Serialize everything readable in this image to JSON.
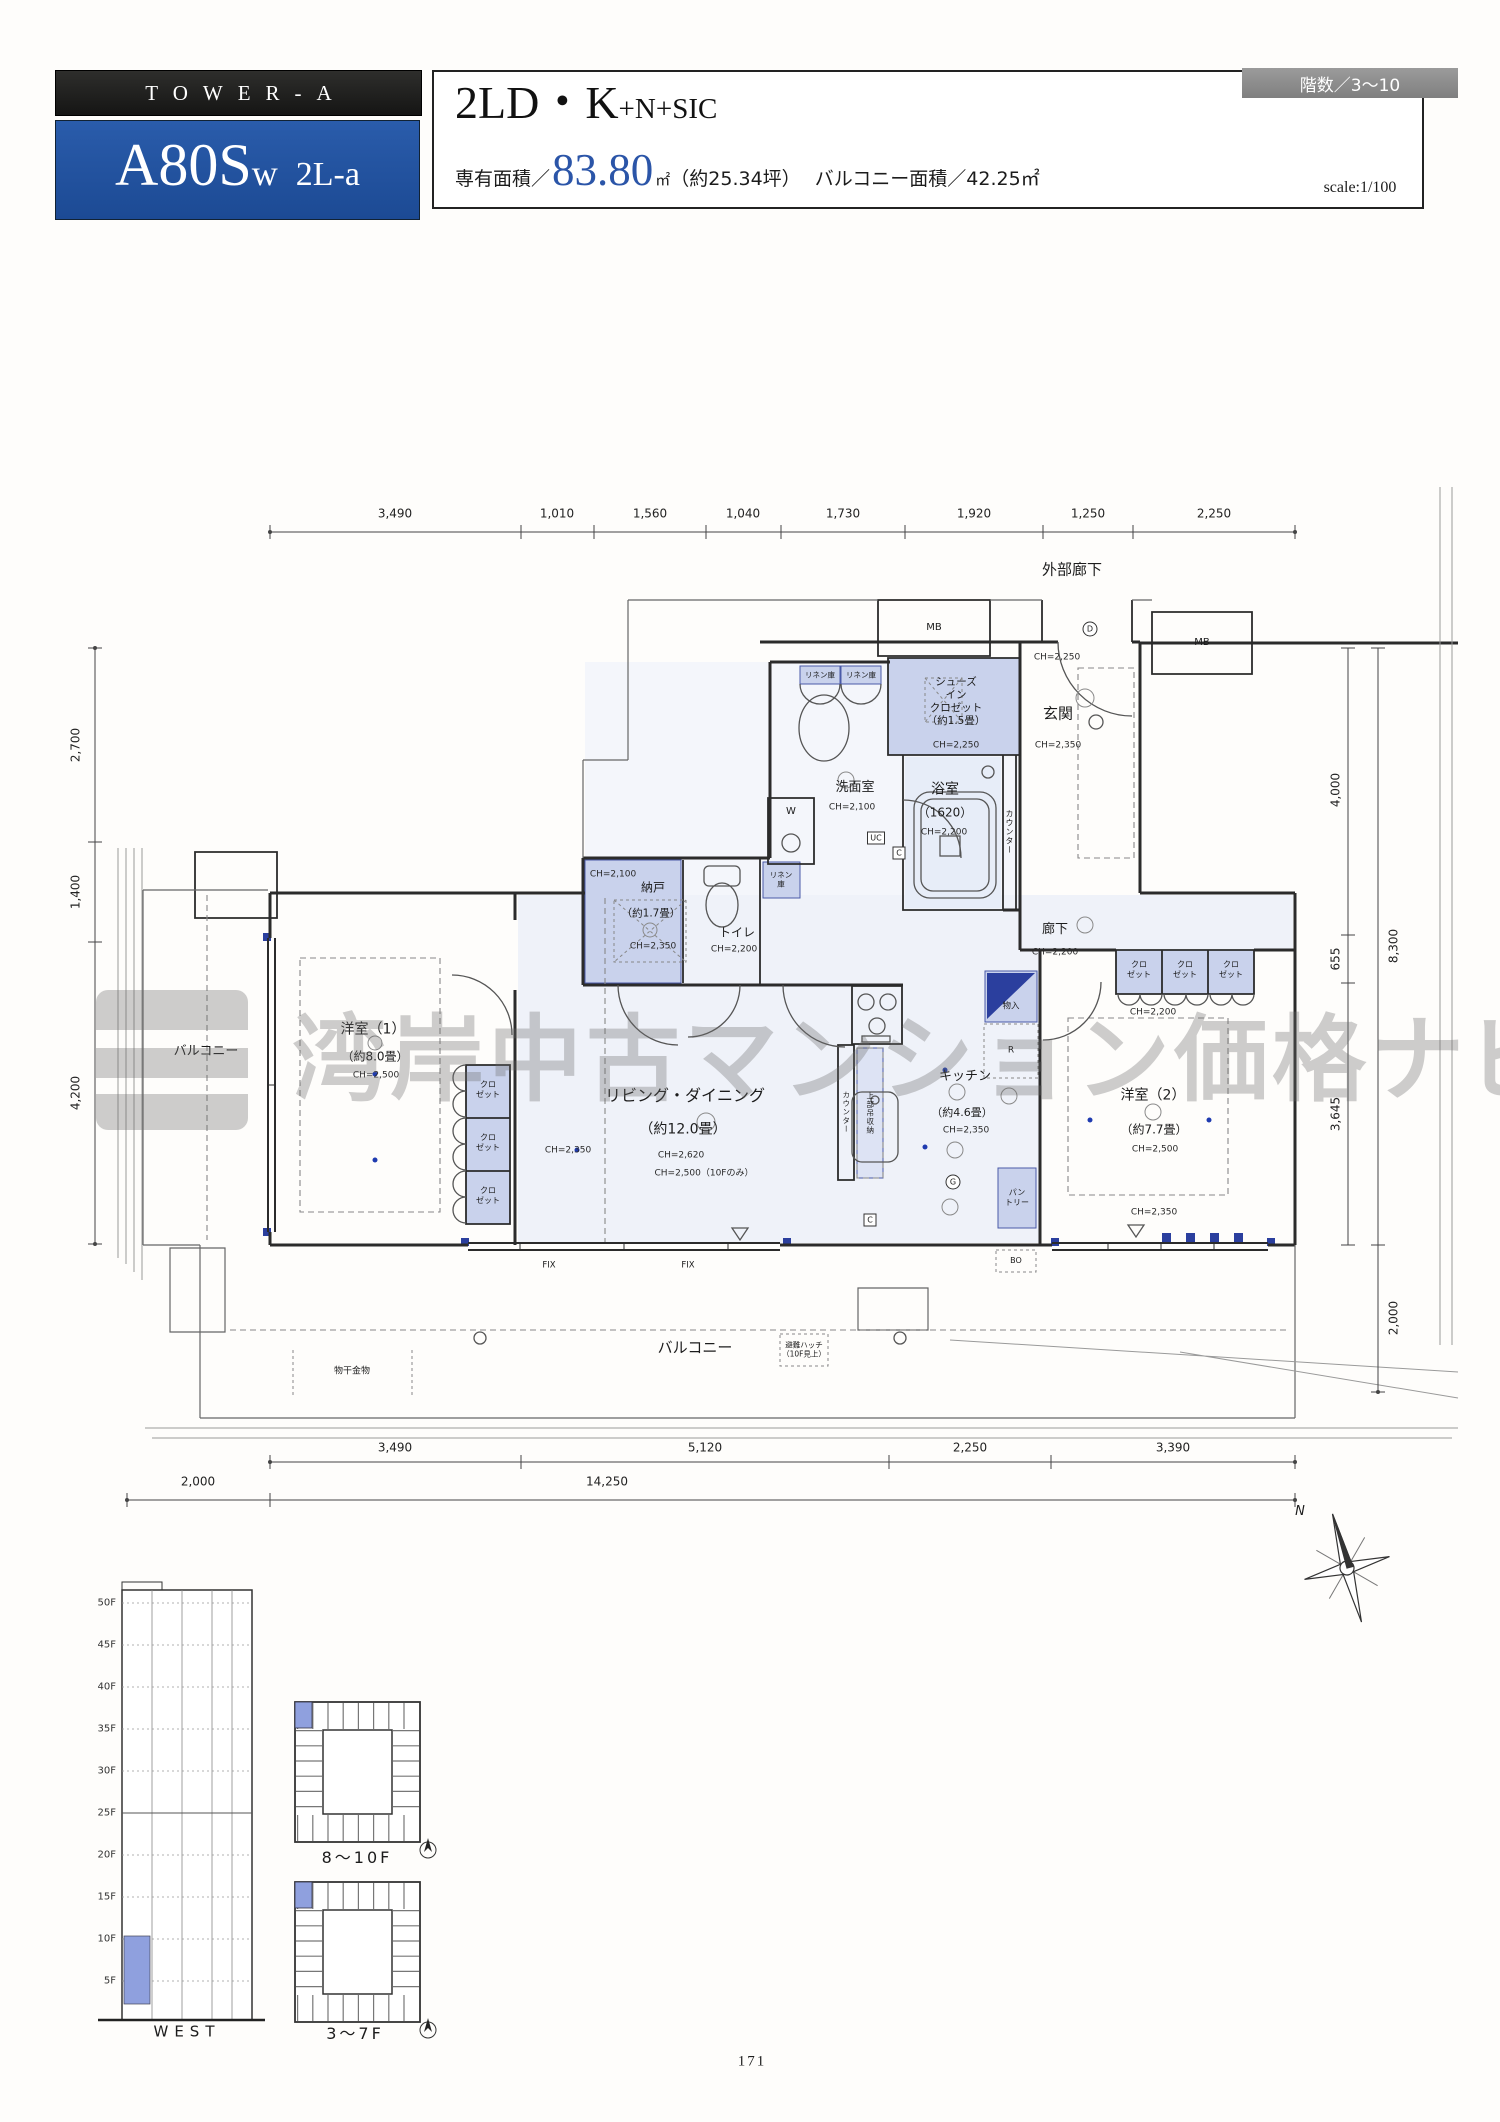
{
  "header": {
    "tower": "TOWER-A",
    "unit_main": "A80S",
    "unit_sub": "w",
    "unit_variant": "2L-a",
    "floors_badge": "階数／3～10",
    "plan_main": "2LD・K",
    "plan_suffix": "+N+SIC",
    "area_prefix": "専有面積／",
    "area_value": "83.80",
    "area_unit": "㎡",
    "area_tsubo": "（約25.34坪）",
    "balcony_area": "バルコニー面積／42.25㎡",
    "scale": "scale:1/100"
  },
  "dims": {
    "top": [
      "3,490",
      "1,010",
      "1,560",
      "1,040",
      "1,730",
      "1,920",
      "1,250",
      "2,250"
    ],
    "left": [
      "2,700",
      "1,400",
      "4,200"
    ],
    "right": [
      "4,000",
      "655",
      "3,645"
    ],
    "right_total": "8,300",
    "right_balcony": "2,000",
    "bottom": [
      "3,490",
      "5,120",
      "2,250",
      "3,390"
    ],
    "bottom_total": "14,250",
    "bottom_left": "2,000"
  },
  "plan": {
    "ext_corridor": "外部廊下",
    "mb": "MB",
    "linen": "リネン庫",
    "linen2": "リネン\n庫",
    "sic": "シューズ\nイン\nクロゼット\n（約1.5畳）",
    "sic_ch": "CH=2,250",
    "genkan": "玄関",
    "genkan_ch": "CH=2,350",
    "genkan_ch2": "CH=2,250",
    "wash": "洗面室",
    "wash_ch": "CH=2,100",
    "washer": "W",
    "bath": "浴室",
    "bath_size": "（1620）",
    "bath_ch": "CH=2,200",
    "uc": "UC",
    "c": "C",
    "d": "D",
    "g": "G",
    "r": "R",
    "bo": "BO",
    "counter": "カウンター",
    "nando": "納戸",
    "nando_size": "（約1.7畳）",
    "nando_ch1": "CH=2,100",
    "nando_ch2": "CH=2,350",
    "toilet": "トイレ",
    "toilet_ch": "CH=2,200",
    "hall": "廊下",
    "hall_ch": "CH=2,200",
    "closet": "クロ\nゼット",
    "closet_ch": "CH=2,200",
    "monoire": "物入",
    "kitchen": "キッチン",
    "kitchen_size": "（約4.6畳）",
    "kitchen_ch": "CH=2,350",
    "hanging": "上部吊収納",
    "pantry": "パン\nトリー",
    "ld": "リビング・ダイニング",
    "ld_size": "（約12.0畳）",
    "ld_ch1": "CH=2,350",
    "ld_ch2": "CH=2,620",
    "ld_ch3": "CH=2,500（10Fのみ）",
    "west1": "洋室（1）",
    "west1_size": "（約8.0畳）",
    "west1_ch": "CH=2,500",
    "west2": "洋室（2）",
    "west2_size": "（約7.7畳）",
    "west2_ch1": "CH=2,500",
    "west2_ch2": "CH=2,350",
    "balcony": "バルコニー",
    "fix": "FIX",
    "monohoshi": "物干金物",
    "hatch": "避難ハッチ\n（10F見上）",
    "compass_n": "N"
  },
  "elevation": {
    "floors": [
      "50F",
      "45F",
      "40F",
      "35F",
      "30F",
      "25F",
      "20F",
      "15F",
      "10F",
      "5F"
    ],
    "west": "WEST"
  },
  "keyplates": {
    "upper": "8～10F",
    "lower": "3～7F"
  },
  "watermark": "湾岸中古マンション価格ナビ",
  "page": "171"
}
